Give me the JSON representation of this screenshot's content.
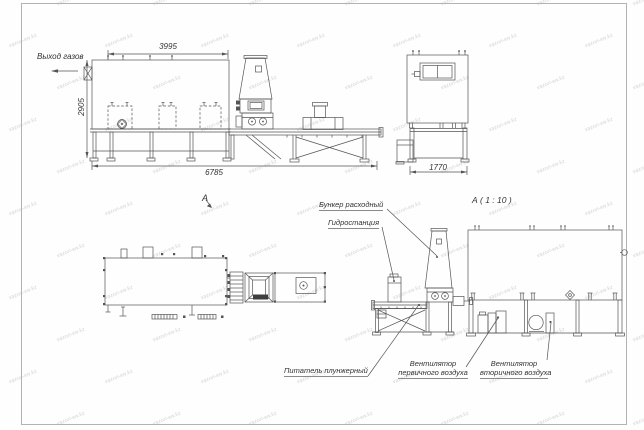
{
  "watermark": {
    "text": "vazon-wv.kz"
  },
  "side_view": {
    "gas_outlet": "Выход газов",
    "dim_width_top": "3995",
    "dim_height": "2905",
    "dim_length": "6785"
  },
  "end_view": {
    "dim_width": "1770"
  },
  "plan_view": {
    "marker": "А"
  },
  "section_view": {
    "title": "А ( 1 : 10 )",
    "labels": {
      "hopper": "Бункер расходный",
      "hydrostation": "Гидростанция",
      "feeder": "Питатель плунжерный",
      "fan_primary_line1": "Вентилятор",
      "fan_primary_line2": "первичного воздуха",
      "fan_secondary_line1": "Вентилятор",
      "fan_secondary_line2": "вторичного воздуха"
    }
  }
}
